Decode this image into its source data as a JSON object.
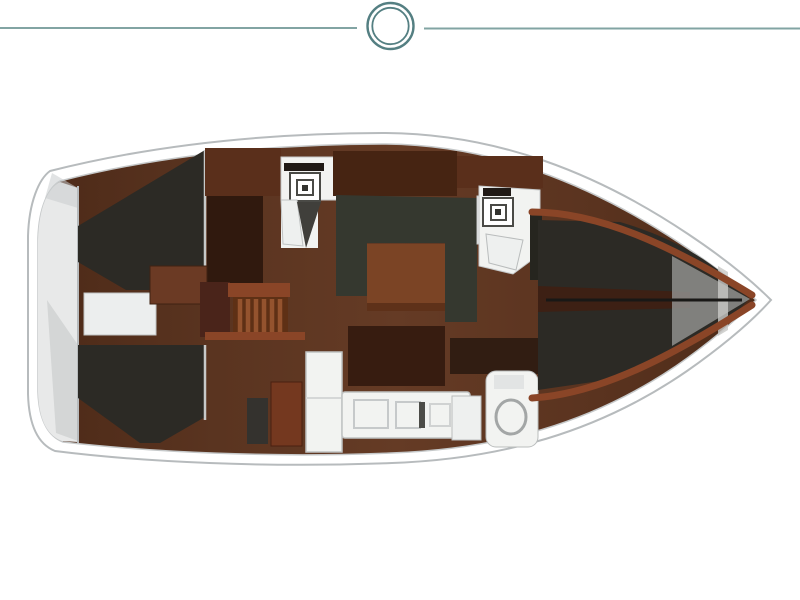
{
  "meta": {
    "description": "Top-view interior floor plan of a sailing yacht, bow pointing right, stern at left",
    "background": "#ffffff"
  },
  "header": {
    "ornament_icon": "double-ring-circle",
    "divider_icon": "horizontal-rule"
  },
  "regions": {
    "names": [
      "swim-platform",
      "aft-cabin-starboard",
      "aft-cabin-port",
      "berth-cushion",
      "nav-desk",
      "companionway-stairs",
      "mid-head-with-sink",
      "saloon-u-seating",
      "saloon-table",
      "galley-bench",
      "galley-refrigerator",
      "galley-counter-with-sink",
      "aft-head-with-toilet",
      "forward-head-with-sink",
      "v-berth",
      "bow"
    ]
  },
  "palette": {
    "line_teal": "#82a4a3",
    "ring_teal": "#547f82",
    "hull_white": "#ffffff",
    "hull_outline": "#b7bbbd",
    "deck_liner": "#c6c9ca",
    "platform_gray": "#e8e9e9",
    "platform_shade": "#c9cccd",
    "cabin_dark": "#2c2a25",
    "seat_green": "#35382f",
    "table_brown": "#7b4425",
    "table_edge": "#5e3119",
    "stairs_wood": "#5e3015",
    "stairs_slat": "#94532e",
    "trim_rust": "#8a4527",
    "maroon_block": "#4a241a",
    "locker_dark": "#30190e",
    "cabinet_brown": "#5a2f1b",
    "cabinet_forward": "#462412",
    "cabinet_red": "#74381f",
    "bench_dark": "#371c10",
    "vanity_dark": "#311d12",
    "appliance_gray": "#34322e",
    "fixture_white": "#f2f3f1",
    "fixture_soft": "#eef0ef",
    "fixture_stroke": "#c0c3c3",
    "sink_stroke": "#4a4a46",
    "label_dark": "#201a16",
    "door_shadow": "#403f3b",
    "berth_split": "#3d2014",
    "berth_gray": "#8f8f8d",
    "berth_bright": "#c8c8c6",
    "divider_light": "#c7c9c9",
    "split_line": "#191816"
  }
}
